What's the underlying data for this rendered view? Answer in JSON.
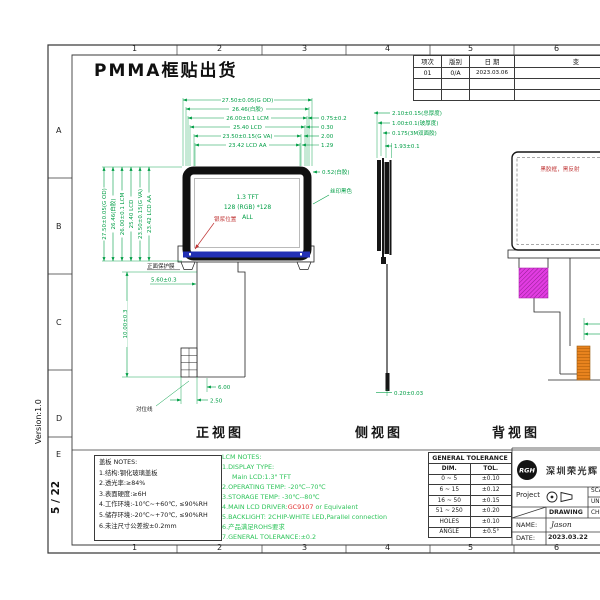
{
  "page": {
    "title": "PMMA框贴出货",
    "version": "Version:1.0",
    "page_no": "5 / 22"
  },
  "grid": {
    "cols": [
      "1",
      "2",
      "3",
      "4",
      "5",
      "6"
    ],
    "rows": [
      "A",
      "B",
      "C",
      "D",
      "E"
    ]
  },
  "revision": {
    "headers": [
      "项次",
      "版别",
      "日 期",
      "变"
    ],
    "row": [
      "01",
      "0/A",
      "2023.03.06"
    ]
  },
  "front": {
    "label": "正视图",
    "screen": [
      "1.3  TFT",
      "128 (RGB) *128",
      "ALL"
    ],
    "top_dims": [
      "27.50±0.05(G OD)",
      "26.46(白胶)",
      "26.00±0.1  LCM",
      "25.40  LCD",
      "23.50±0.15(G VA)",
      "23.42  LCD AA"
    ],
    "left_dims": [
      "27.50±0.05(G OD)",
      "26.46(白胶)",
      "26.00±0.1  LCM",
      "25.40  LCD",
      "23.50±0.15(G VA)",
      "23.42  LCD AA"
    ],
    "right_dims": [
      "0.75±0.2",
      "0.30",
      "2.00",
      "1.29"
    ],
    "right_note": "0.52(白胶)",
    "tail_dims": {
      "length": "10.00±0.3",
      "width": "5.60±0.3",
      "offset": "6.00",
      "finger": "2.50"
    },
    "labels": {
      "paste": "银浆位置",
      "silk": "丝印黑色",
      "film": "正面保护膜",
      "align": "对位线"
    }
  },
  "side": {
    "label": "侧视图",
    "dims": [
      "2.10±0.15(总厚度)",
      "1.00±0.1(玻厚度)",
      "0.175(3M双面胶)",
      "1.93±0.1",
      "0.20±0.03"
    ]
  },
  "back": {
    "label": "背视图",
    "note": "黑胶框，黑反射"
  },
  "cover_notes": {
    "title": "盖板 NOTES:",
    "items": [
      "1.结构:钢化玻璃盖板",
      "2.透光率:≥84%",
      "3.表面硬度:≥6H",
      "4.工作环境:-10℃~+60℃, ≤90%RH",
      "5.储存环境:-20℃~+70℃, ≤90%RH",
      "6.未注尺寸公差按±0.2mm"
    ]
  },
  "lcm_notes": {
    "title": "LCM NOTES:",
    "l1": "1.DISPLAY TYPE:",
    "l1b": "Main LCD:1.3\" TFT",
    "l2": "2.OPERATING TEMP: -20℃--70℃",
    "l3": "3.STORAGE TEMP: -30℃--80℃",
    "l4a": "4.MAIN LCD DRIVER:",
    "l4b": "GC9107",
    "l4c": " or Equivalent",
    "l5": "5.BACKLIGHT: 2CHIP-WHITE LED,Parallel connection",
    "l6": "6.产品满足ROHS要求",
    "l7": "7.GENERAL TOLERANCE:±0.2"
  },
  "tolerance": {
    "title": "GENERAL TOLERANCE",
    "dim_h": "DIM.",
    "tol_h": "TOL.",
    "rows": [
      [
        "0 ~ 5",
        "±0.10"
      ],
      [
        "6 ~ 15",
        "±0.12"
      ],
      [
        "16 ~ 50",
        "±0.15"
      ],
      [
        "51 ~ 250",
        "±0.20"
      ],
      [
        "HOLES",
        "±0.10"
      ],
      [
        "ANGLE",
        "±0.5°"
      ]
    ]
  },
  "title_block": {
    "logo": "RGH",
    "company": "深圳荣光辉",
    "project_label": "Project",
    "drawing_label": "DRAWING",
    "name_label": "NAME:",
    "name_value": "Jason",
    "date_label": "DATE:",
    "date_value": "2023.03.22",
    "scale_label": "SCA",
    "unit_label": "UN",
    "check_label": "CHE"
  },
  "colors": {
    "dim_green": "#009e45",
    "note_green": "#2ec45a",
    "red": "#c03636",
    "blue_bar": "#2230b5",
    "magenta": "#e23ce2",
    "orange": "#e8831e"
  }
}
